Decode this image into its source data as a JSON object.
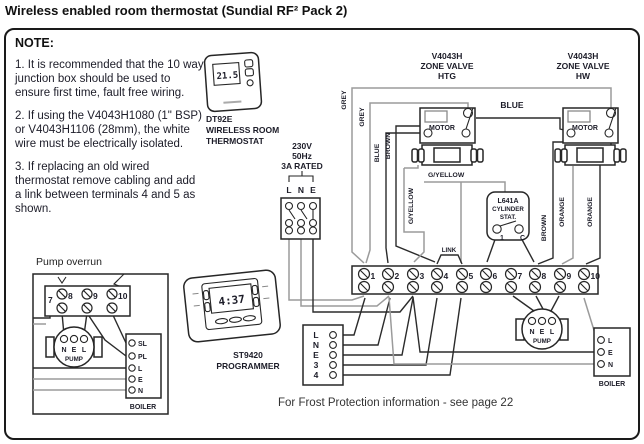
{
  "title": "Wireless enabled room thermostat (Sundial RF² Pack 2)",
  "note": {
    "heading": "NOTE:",
    "items": [
      "1. It is recommended that the 10 way junction box should be used to ensure first time, fault free wiring.",
      "2. If using the V4043H1080 (1\" BSP) or V4043H1106 (28mm), the white wire must be electrically isolated.",
      "3. If replacing an old wired thermostat remove cabling and add a link between terminals 4 and 5 as shown."
    ]
  },
  "thermostat": {
    "display": "21.5",
    "label": [
      "DT92E",
      "WIRELESS ROOM",
      "THERMOSTAT"
    ]
  },
  "supply": {
    "rating": [
      "230V",
      "50Hz",
      "3A RATED"
    ],
    "terminals": [
      "L",
      "N",
      "E"
    ]
  },
  "valve_htg": {
    "name": [
      "V4043H",
      "ZONE VALVE",
      "HTG"
    ],
    "motor": "MOTOR"
  },
  "valve_hw": {
    "name": [
      "V4043H",
      "ZONE VALVE",
      "HW"
    ],
    "motor": "MOTOR"
  },
  "cylinder_stat": {
    "name": [
      "L641A",
      "CYLINDER",
      "STAT."
    ],
    "terminals": [
      "1",
      "C"
    ]
  },
  "wires": {
    "grey_a": "GREY",
    "grey_b": "GREY",
    "blue_v": "BLUE",
    "blue_h": "BLUE",
    "brown_v": "BROWN",
    "brown_r": "BROWN",
    "gyellow_v": "G/YELLOW",
    "gyellow_h": "G/YELLOW",
    "orange_a": "ORANGE",
    "orange_b": "ORANGE",
    "link": "LINK"
  },
  "junction_box": {
    "terminals": [
      "1",
      "2",
      "3",
      "4",
      "5",
      "6",
      "7",
      "8",
      "9",
      "10"
    ]
  },
  "pump": {
    "terminals": [
      "N",
      "E",
      "L"
    ],
    "label": "PUMP"
  },
  "boiler": {
    "terminals": [
      "L",
      "E",
      "N"
    ],
    "label": "BOILER"
  },
  "pump_overrun": {
    "title": "Pump overrun",
    "first_terminal": "7",
    "strip_terminals": [
      "8",
      "9",
      "10"
    ],
    "pump": {
      "terminals": [
        "N",
        "E",
        "L"
      ],
      "label": "PUMP"
    },
    "boiler": {
      "terminals": [
        "SL",
        "PL",
        "L",
        "E",
        "N"
      ],
      "label": "BOILER"
    }
  },
  "programmer": {
    "display": "4:37",
    "label": [
      "ST9420",
      "PROGRAMMER"
    ],
    "terminals": [
      "L",
      "N",
      "E",
      "3",
      "4"
    ]
  },
  "footer": "For Frost Protection information - see page 22"
}
